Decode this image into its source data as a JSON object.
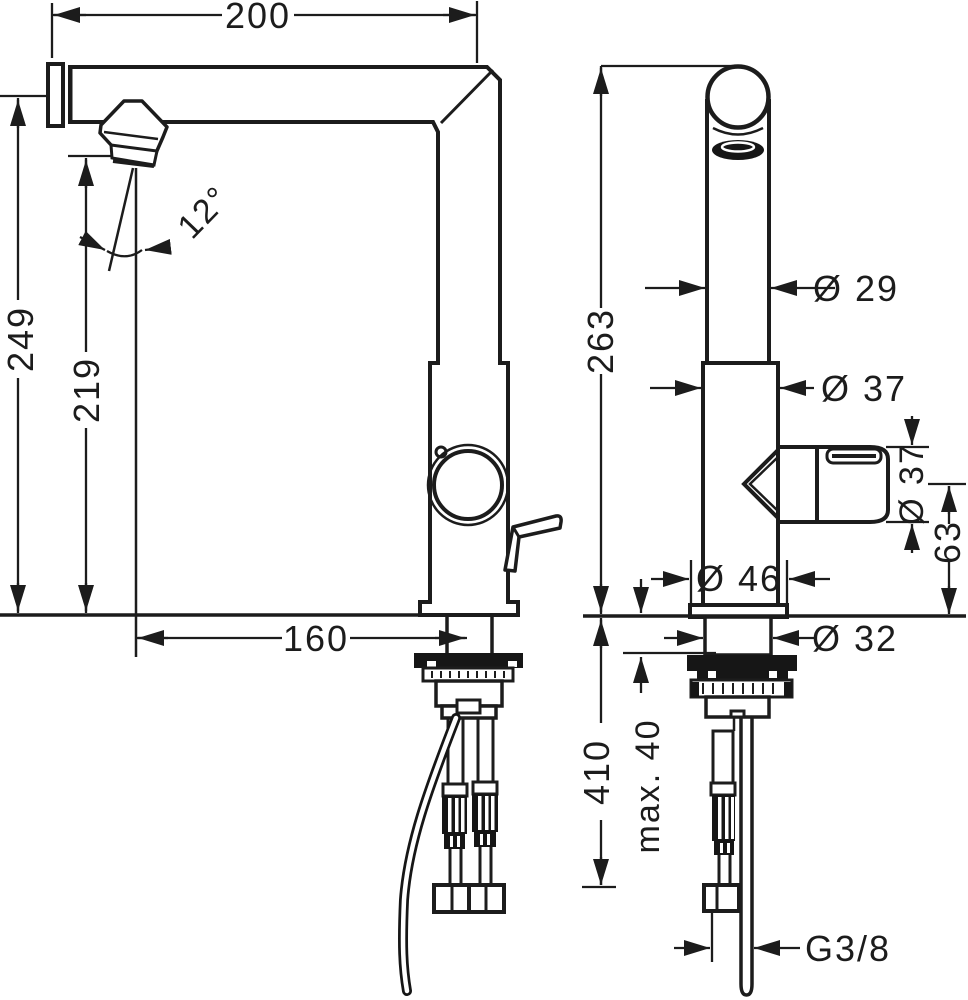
{
  "title": "Faucet technical dimension drawing, front and side views",
  "colors": {
    "ink": "#1c1c1c",
    "background": "#ffffff"
  },
  "drawing": {
    "front_view": {
      "dims": {
        "spout_reach": "200",
        "total_height": "249",
        "spout_clearance": "219",
        "stream_angle": "12°",
        "outlet_offset": "160"
      }
    },
    "side_view": {
      "dims": {
        "height_above_deck": "263",
        "spout_diameter": "Ø 29",
        "body_diameter": "Ø 37",
        "handle_diameter": "Ø 37",
        "handle_axis_height": "63",
        "base_diameter": "Ø 46",
        "shank_diameter": "Ø 32",
        "hose_length": "410",
        "max_counter_thickness": "max. 40",
        "connection_thread": "G3/8"
      }
    }
  }
}
